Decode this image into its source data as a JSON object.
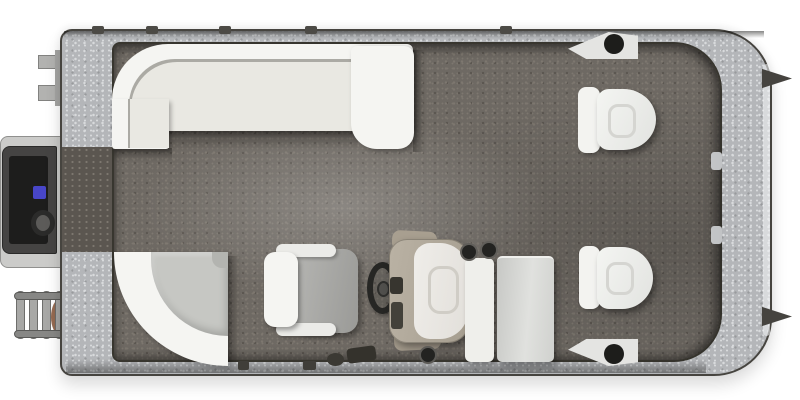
{
  "page": {
    "title": "Pontoon Boat Floorplan - Overhead View",
    "background": "#ffffff"
  },
  "colors": {
    "page_bg": "#ffffff",
    "band": "#b4b6b9",
    "band_light": "#d8dadc",
    "band_dark": "#989a9d",
    "carpet": "#6e6963",
    "carpet_light": "#7d776f",
    "carpet_dark": "#5b5650",
    "white": "#f5f5f2",
    "cream": "#e9e8e2",
    "corner_seat": "#c6c7c3",
    "console_tan": "#bab2a4",
    "console_white": "#efede9",
    "label_blue": "#4846c8",
    "rust": "#8a5a3e"
  },
  "components": {
    "deck": "pontoon deck with speckled gunwale trim",
    "carpet": "gray marine carpet floor",
    "stern_gate": "stern walk-through gate opening",
    "stern_platform": "stern motor pod platform",
    "outboard_motor": "outboard motor (top view)",
    "boarding_ladder": "folding boarding ladder",
    "port_stern_lounge": "wrap-around L-lounge seat, aft port corner",
    "chaise_armrest": "chaise lounge armrest end",
    "corner_curve_lounge": "quarter-round corner lounge, forward port corner",
    "captain_chair": "captain's helm chair with armrests",
    "steering_wheel": "steering wheel",
    "helm_console": "helm console with windscreen and gauge panel",
    "jump_seat": "seat back panel beside console",
    "cooler_bench": "bench / cooler seat",
    "bow_chair_port": "bow pedestal fishing chair (upper)",
    "bow_chair_starboard": "bow pedestal fishing chair (lower)",
    "cleat": "mooring cleat with fairlead hole",
    "bow_horn": "bow rail fitting",
    "rail_joint": "fence rail joint mark",
    "cup_holders": "cup holders",
    "ski_tow_fittings": "aft deck fittings"
  }
}
